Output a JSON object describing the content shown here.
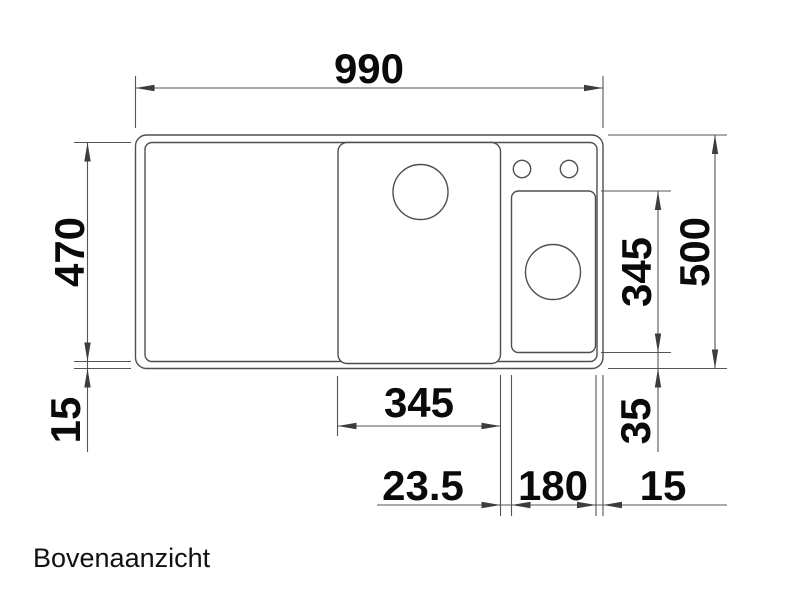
{
  "caption": "Bovenaanzicht",
  "dimensions": {
    "overall_width": "990",
    "overall_depth": "500",
    "inner_rim_depth": "470",
    "rim_offset_bottom_left": "15",
    "main_bowl_width": "345",
    "small_bowl_depth": "345",
    "small_bowl_offset_bottom": "35",
    "bowl_gap": "23.5",
    "small_bowl_width": "180",
    "rim_offset_right": "15"
  },
  "colors": {
    "background": "#ffffff",
    "line": "#4f4f4f",
    "text": "#0a0a0a"
  }
}
